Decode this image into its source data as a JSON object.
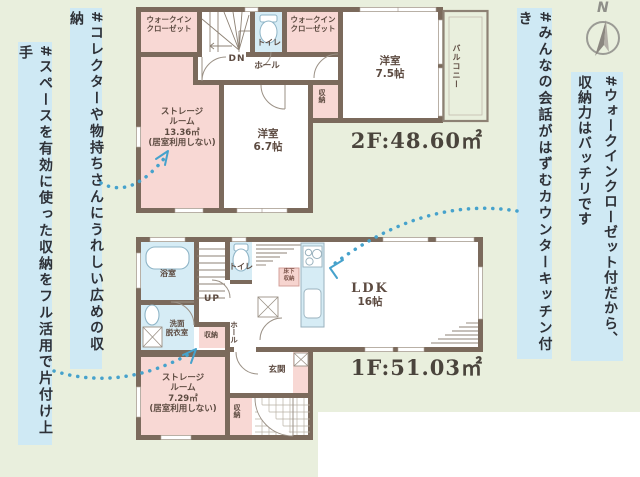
{
  "annotations": {
    "left_outer": "#スペースを有効に使った収納をフル活用で片付け上手",
    "left_inner": "#コレクターや物持ちさんにうれしい広めの収納",
    "right_inner": "#みんなの会話がはずむカウンターキッチン付き",
    "right_outer": "#ウォークインクローゼット付だから、\n収納力はバッチリです"
  },
  "compass": {
    "north_label": "N"
  },
  "floor2": {
    "area_label": "2F:48.60㎡",
    "rooms": {
      "wic_left": "ウォークイン\nクローゼット",
      "stairs_dn": "DN",
      "toilet": "トイレ",
      "wic_right": "ウォークイン\nクローゼット",
      "hall": "ホール",
      "storage": "ストレージ\nルーム\n13.36㎡\n(居室利用しない)",
      "bedroom_67": "洋室\n6.7帖",
      "closet": "収納",
      "bedroom_75": "洋室\n7.5帖",
      "balcony": "バルコニー"
    }
  },
  "floor1": {
    "area_label": "1F:51.03㎡",
    "rooms": {
      "bath": "浴室",
      "stairs_up": "UP",
      "toilet": "トイレ",
      "washroom": "洗面\n脱衣室",
      "closet_a": "収納",
      "hall": "ホール",
      "storage": "ストレージ\nルーム\n7.29㎡\n(居室利用しない)",
      "closet_b": "収納",
      "entrance": "玄関",
      "floor_storage": "床下\n収納",
      "ldk": {
        "name": "LDK",
        "size": "16帖"
      }
    }
  },
  "colors": {
    "background": "#e9efdd",
    "wall": "#7b6a5c",
    "room_pink": "#f8d8d4",
    "room_blue": "#d6ecf5",
    "annotation_bg": "#cfe9f4",
    "arrow_blue": "#46a2cc"
  }
}
